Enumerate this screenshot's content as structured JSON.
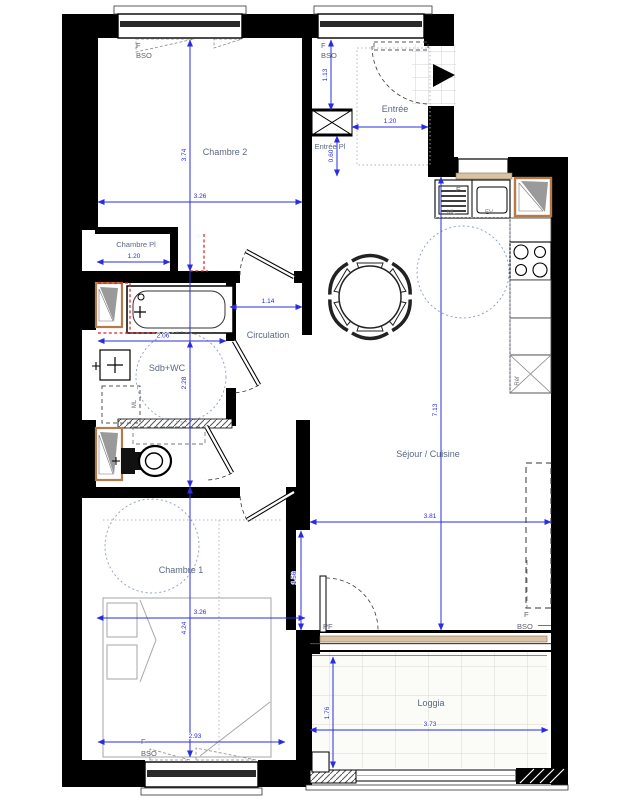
{
  "rooms": {
    "chambre2": "Chambre 2",
    "entree": "Entrée",
    "entree_pl": "Entrée Pl",
    "chambre_pl": "Chambre Pl",
    "circulation": "Circulation",
    "sdb_wc": "Sdb+WC",
    "sejour_cuisine": "Séjour / Cuisine",
    "chambre1": "Chambre 1",
    "loggia": "Loggia"
  },
  "dims": {
    "chambre2_h": "3.74",
    "chambre2_w": "3.26",
    "entree_h": "1.13",
    "entree_w": "1.20",
    "entree_pl_h": "0.60",
    "chambre_pl_w": "1.20",
    "circulation_w": "1.14",
    "sdb_w": "2.06",
    "sdb_h": "2.28",
    "sejour_h": "7.13",
    "sejour_w": "3.81",
    "sejour_e": "1.56",
    "chambre1_w": "3.26",
    "chambre1_h": "4.24",
    "chambre1_w2": "2.93",
    "loggia_w": "3.73",
    "loggia_h": "1.76"
  },
  "labels": {
    "f": "F",
    "bso": "BSO",
    "pf": "PF",
    "ml": "ML",
    "ev": "EV",
    "ref": "Réf"
  },
  "colors": {
    "dimension": "#2a2ce0",
    "wall": "#000000",
    "room_label": "#5a6880",
    "opening_label": "#5f6470",
    "alert_red": "#e02020",
    "window_sill": "#d9c3a5",
    "duct_border": "#b5794a"
  }
}
